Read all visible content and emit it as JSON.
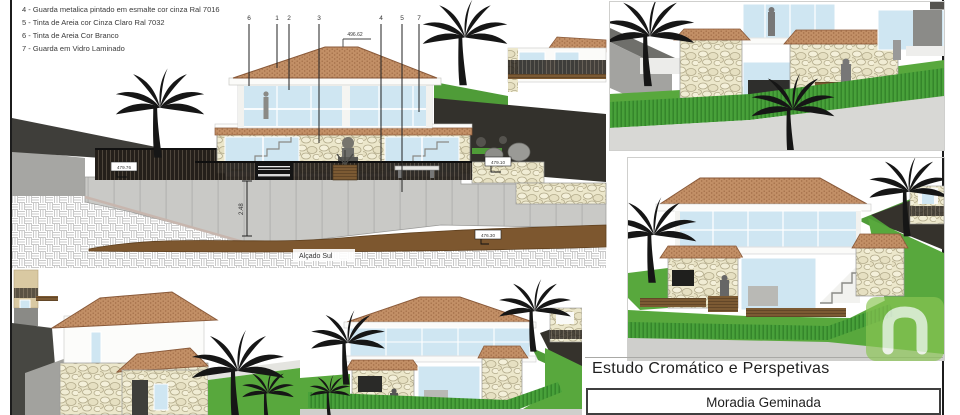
{
  "legend": {
    "items": [
      "4 - Guarda metalica pintado em esmalte cor cinza Ral 7016",
      "5 - Tinta de Areia cor Cinza Claro Ral 7032",
      "6 - Tinta de Areia Cor Branco",
      "7 - Guarda em Vidro Laminado"
    ]
  },
  "elevation": {
    "caption": "Alçado Sul",
    "callouts": [
      "6",
      "1",
      "2",
      "3",
      "4",
      "5",
      "7"
    ],
    "levels": {
      "ridge": "496.62",
      "terrace_left": "479.76",
      "terrace_right": "479.10",
      "ground": "476.30"
    },
    "dimension_height": "2.48"
  },
  "title_block": {
    "study_title": "Estudo Cromático e Perspetivas",
    "project_name": "Moradia Geminada"
  },
  "watermark": {
    "logo": "imovirtual-n-logo"
  },
  "colors": {
    "roof_terracotta": "#c28f66",
    "stone_cladding": "#ece7cb",
    "glass_blue": "#cfe6f2",
    "lawn_green": "#58a83d",
    "fence_green": "#48a13a",
    "soil_brown": "#7d572f",
    "hillside_dark": "#33312c",
    "concrete_grey": "#c9c9c6",
    "watermark_green": "#8bc653"
  }
}
